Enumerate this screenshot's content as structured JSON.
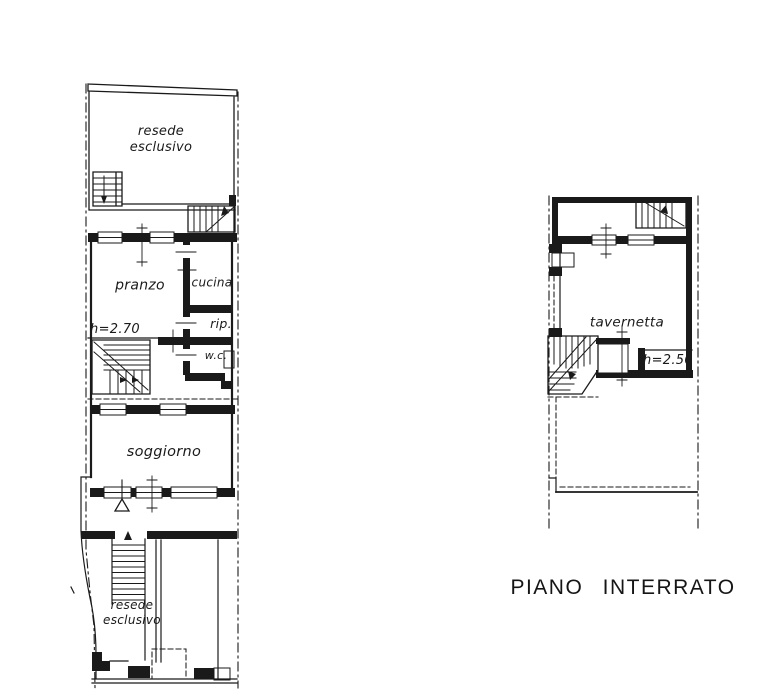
{
  "drawing": {
    "paper_color": "#ffffff",
    "ink_color": "#1a1a1a",
    "caption": "PIANO INTERRATO",
    "ground_floor": {
      "labels": {
        "resede_top_line1": "resede",
        "resede_top_line2": "esclusivo",
        "pranzo": "pranzo",
        "cucina": "cucina",
        "height_note": "h=2.70",
        "rip": "rip.",
        "wc": "w.c.",
        "soggiorno": "soggiorno",
        "resede_bottom_line1": "resede",
        "resede_bottom_line2": "esclusivo"
      }
    },
    "basement": {
      "labels": {
        "tavernetta": "tavernetta",
        "height_note": "h=2.50"
      }
    }
  }
}
